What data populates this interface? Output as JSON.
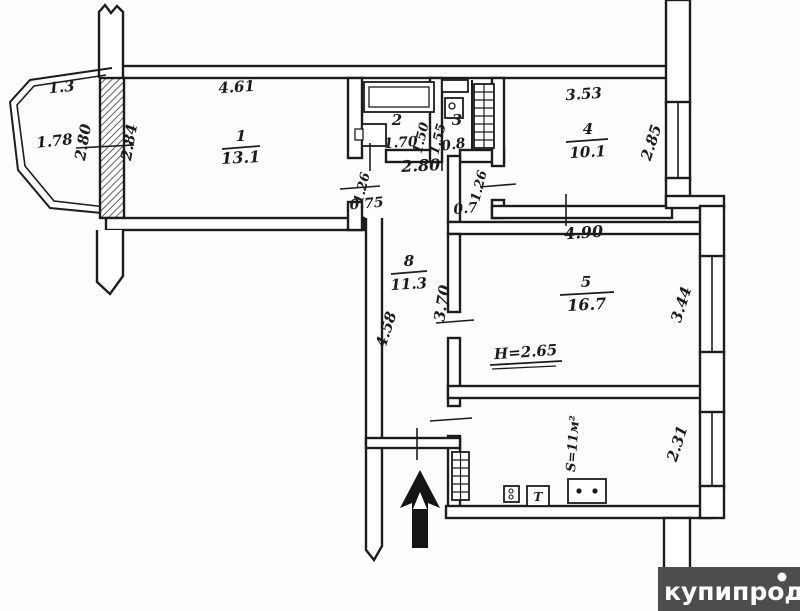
{
  "page": {
    "background": "#fdfdfd",
    "line_color": "#1c1c1c"
  },
  "watermark": {
    "text": "купипродай",
    "bg": "#4d4d4d",
    "fg": "#ffffff"
  },
  "floorplan": {
    "rooms": [
      {
        "number": "1",
        "area": "13.1",
        "width": "4.61"
      },
      {
        "number": "2",
        "width": "1.70",
        "depth": "1.50",
        "fixtures": [
          "bathtub",
          "sink"
        ]
      },
      {
        "number": "3",
        "width": "0.8",
        "depth": "1.55",
        "fixtures": [
          "toilet",
          "cistern",
          "vent-shaft"
        ]
      },
      {
        "number": "4",
        "area": "10.1",
        "width": "3.53",
        "window": "2.85"
      },
      {
        "number": "5",
        "area": "16.7",
        "width": "4.90",
        "window": "3.44",
        "ceiling": "H=2.65"
      },
      {
        "number": "8",
        "area": "11.3",
        "length": "4.58",
        "side": "3.70"
      },
      {
        "number": "kitchen",
        "area": "S=11м²",
        "window": "2.31",
        "fixtures": [
          "fridge-grid",
          "appliance",
          "t-box",
          "stove"
        ]
      }
    ],
    "balcony": {
      "depth": "1.3",
      "width": "1.78",
      "window_dims": [
        "2.80",
        "2.84"
      ]
    },
    "hall_dims": [
      "2.80",
      "1.26",
      "0.75",
      "1.26",
      "0.7"
    ]
  },
  "annotations": [
    {
      "text": "1.3",
      "x": 62,
      "y": 92,
      "rot": -6
    },
    {
      "text": "1.78",
      "x": 55,
      "y": 146,
      "rot": -6
    },
    {
      "text": "2.80",
      "x": 88,
      "y": 143,
      "rot": -80
    },
    {
      "text": "2.84",
      "x": 134,
      "y": 143,
      "rot": -80
    },
    {
      "text": "4.61",
      "x": 237,
      "y": 92,
      "rot": -4
    },
    {
      "text": "1",
      "x": 241,
      "y": 141,
      "rot": 0,
      "size": 15
    },
    {
      "text": "13.1",
      "x": 241,
      "y": 163,
      "rot": -3,
      "size": 16
    },
    {
      "text": "2",
      "x": 397,
      "y": 125,
      "rot": 0
    },
    {
      "text": "1.70",
      "x": 401,
      "y": 147,
      "rot": -4,
      "size": 14
    },
    {
      "text": "1.50",
      "x": 425,
      "y": 139,
      "rot": -76,
      "size": 13
    },
    {
      "text": "1.55",
      "x": 442,
      "y": 140,
      "rot": -76,
      "size": 13
    },
    {
      "text": "3",
      "x": 457,
      "y": 125,
      "rot": 0
    },
    {
      "text": "0.8",
      "x": 454,
      "y": 149,
      "rot": -8,
      "size": 14
    },
    {
      "text": "2.80",
      "x": 421,
      "y": 171,
      "rot": -3,
      "size": 16
    },
    {
      "text": "1.26",
      "x": 366,
      "y": 189,
      "rot": -76,
      "size": 13
    },
    {
      "text": "0.75",
      "x": 367,
      "y": 208,
      "rot": -5,
      "size": 14
    },
    {
      "text": "1.26",
      "x": 483,
      "y": 187,
      "rot": -76,
      "size": 13
    },
    {
      "text": "0.7",
      "x": 466,
      "y": 213,
      "rot": -5,
      "size": 14
    },
    {
      "text": "3.53",
      "x": 584,
      "y": 99,
      "rot": -4
    },
    {
      "text": "4",
      "x": 588,
      "y": 134,
      "rot": 0
    },
    {
      "text": "10.1",
      "x": 588,
      "y": 157,
      "rot": -3
    },
    {
      "text": "2.85",
      "x": 656,
      "y": 144,
      "rot": -72
    },
    {
      "text": "8",
      "x": 409,
      "y": 266,
      "rot": 0
    },
    {
      "text": "11.3",
      "x": 409,
      "y": 289,
      "rot": -3
    },
    {
      "text": "4.58",
      "x": 391,
      "y": 331,
      "rot": -72
    },
    {
      "text": "3.70",
      "x": 447,
      "y": 304,
      "rot": -81
    },
    {
      "text": "4.90",
      "x": 584,
      "y": 238,
      "rot": -4,
      "size": 16
    },
    {
      "text": "5",
      "x": 586,
      "y": 287,
      "rot": 0
    },
    {
      "text": "16.7",
      "x": 587,
      "y": 310,
      "rot": -3,
      "size": 16
    },
    {
      "text": "H=2.65",
      "x": 526,
      "y": 357,
      "rot": -4
    },
    {
      "text": "3.44",
      "x": 686,
      "y": 306,
      "rot": -72
    },
    {
      "text": "S=11м²",
      "x": 577,
      "y": 444,
      "rot": -86,
      "size": 13
    },
    {
      "text": "2.31",
      "x": 682,
      "y": 445,
      "rot": -72
    },
    {
      "text": "Т",
      "x": 538,
      "y": 501,
      "rot": 0,
      "size": 12
    }
  ]
}
